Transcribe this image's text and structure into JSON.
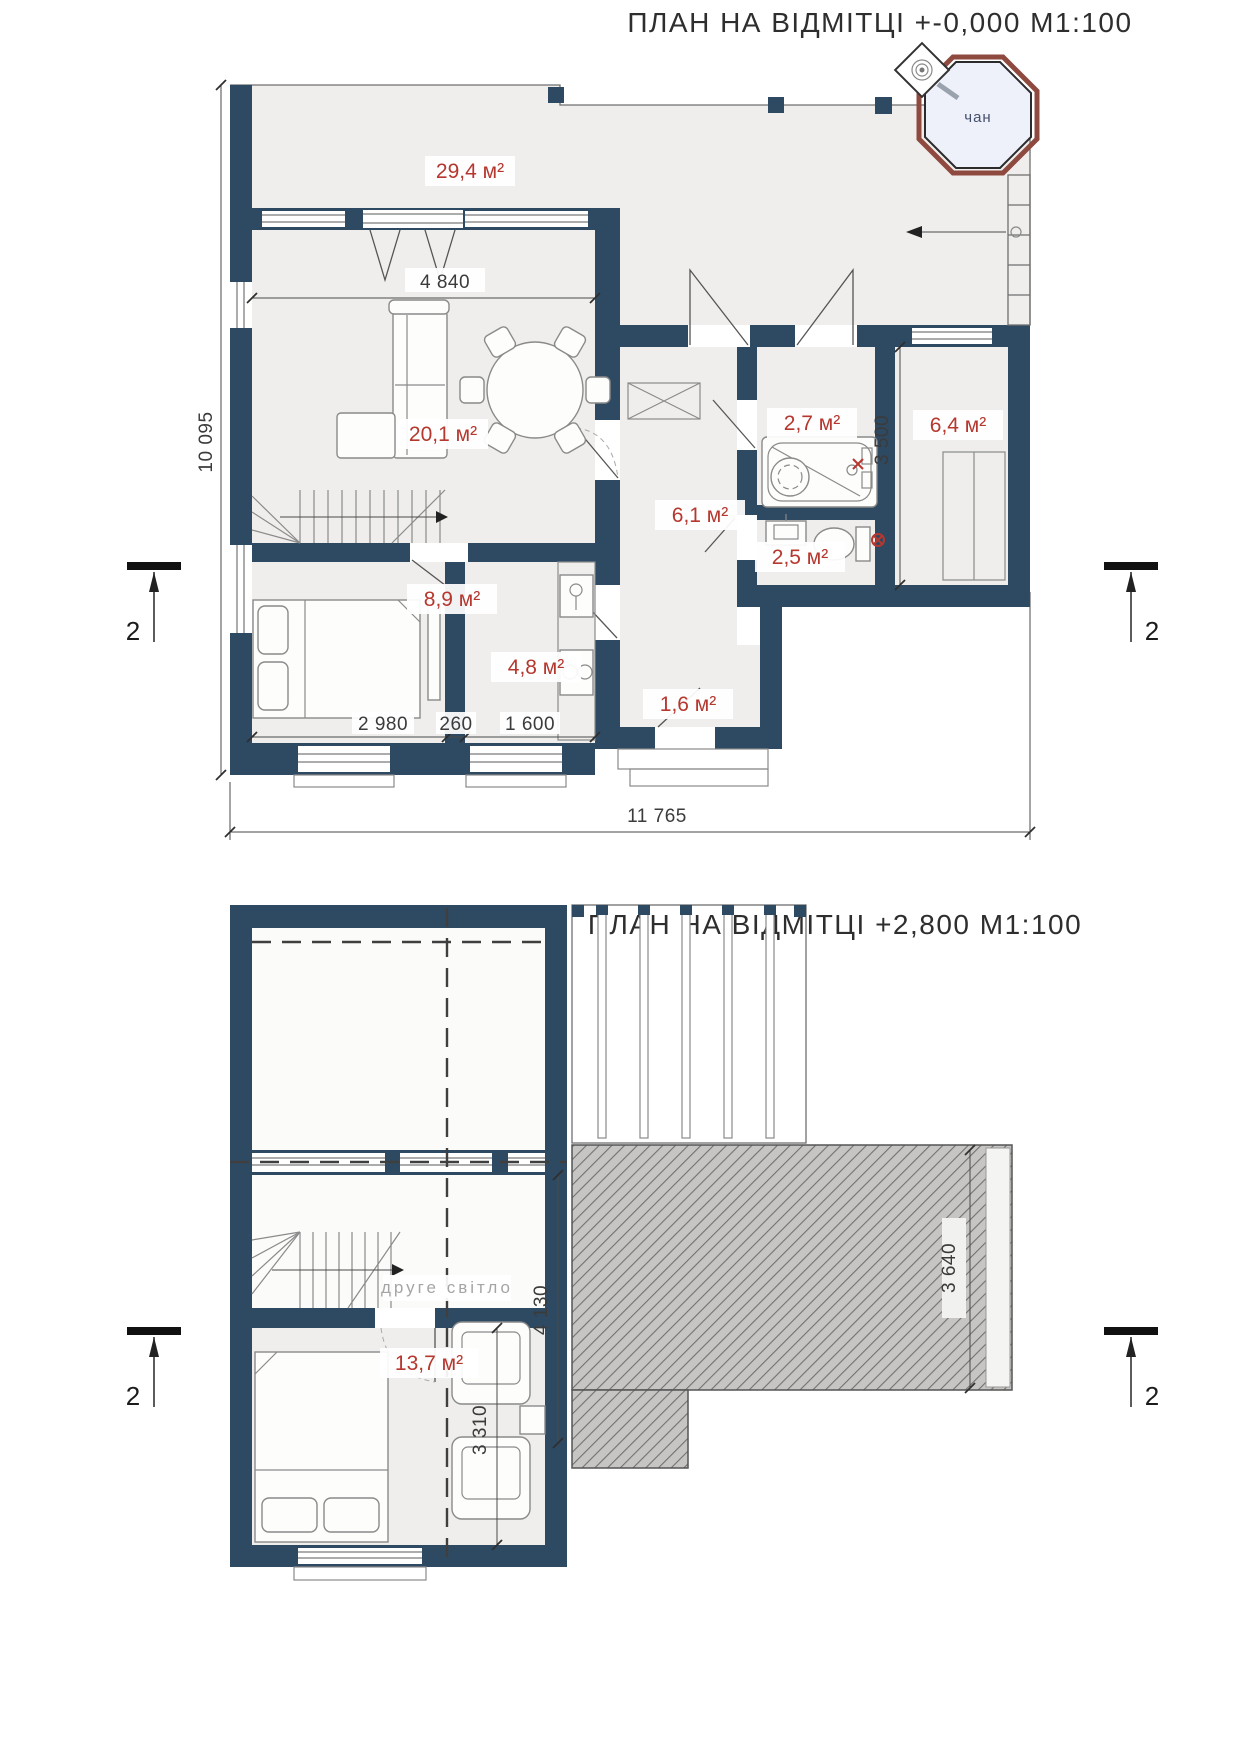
{
  "plan1": {
    "title": "ПЛАН НА ВІДМІТЦІ +-0,000 М1:100",
    "tub_label": "чан",
    "section_mark": "2",
    "areas": {
      "terrace": "29,4 м²",
      "living": "20,1 м²",
      "hall": "6,1 м²",
      "bath": "2,7 м²",
      "wc": "2,5 м²",
      "entry": "6,4 м²",
      "bedroom": "8,9 м²",
      "kitchen": "4,8 м²",
      "vestibule": "1,6 м²"
    },
    "dims": {
      "windows_width": "4 840",
      "total_height": "10 095",
      "entry_height": "3 500",
      "bedroom_width": "2 980",
      "wall": "260",
      "kitchen_width": "1 600",
      "total_width": "11 765"
    }
  },
  "plan2": {
    "title": "ПЛАН НА ВІДМІТЦІ +2,800 М1:100",
    "void_label": "друге світло",
    "section_mark": "2",
    "areas": {
      "bedroom": "13,7 м²"
    },
    "dims": {
      "void_height": "4 130",
      "bedroom_height": "3 310",
      "terrace_height": "3 640"
    }
  },
  "colors": {
    "wall": "#2e4a63",
    "area_label": "#b5372e",
    "tub_ring": "#8f4a40",
    "hatch_base": "#c6c5c3"
  }
}
